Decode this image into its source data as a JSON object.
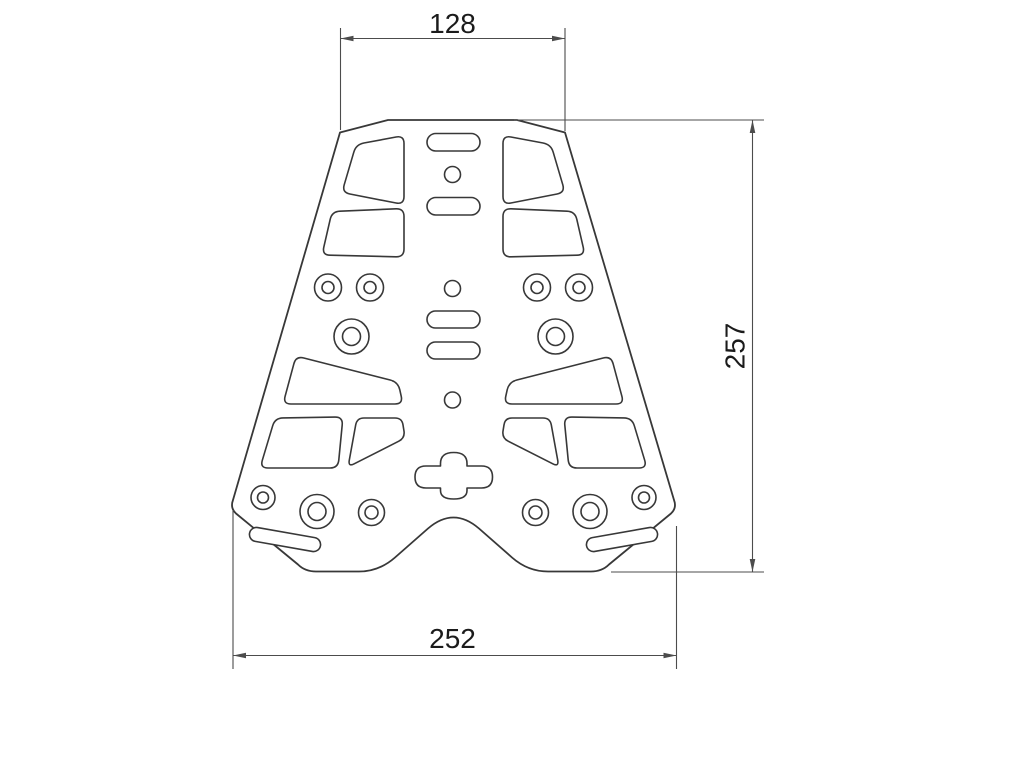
{
  "drawing": {
    "dimensions": {
      "top_width": {
        "value": "128",
        "orientation": "horizontal",
        "position": "top"
      },
      "height": {
        "value": "257",
        "orientation": "vertical",
        "position": "right"
      },
      "bottom_width": {
        "value": "252",
        "orientation": "horizontal",
        "position": "bottom"
      }
    },
    "colors": {
      "background": "#ffffff",
      "part_line": "#383838",
      "dimension_line": "#4c4c4c",
      "text": "#1b1b1b"
    }
  }
}
